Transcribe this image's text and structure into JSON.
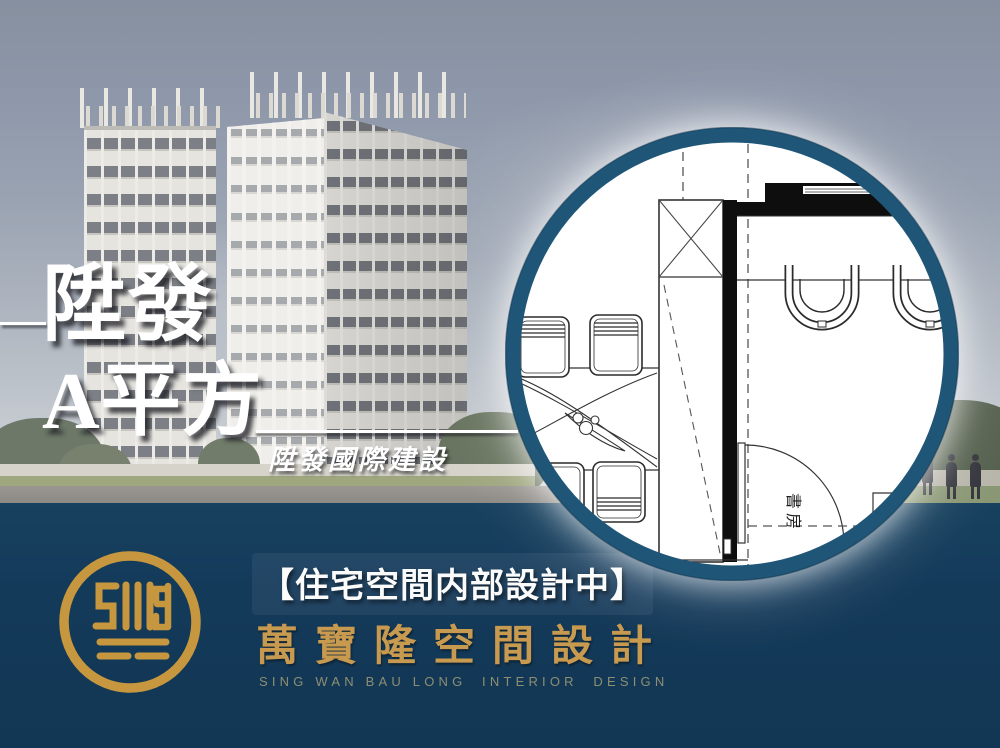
{
  "poster": {
    "title_line1": "陞發",
    "title_line2": "A平方",
    "developer_caption": "陞發國際建設",
    "floor_plan": {
      "room_label": "書房"
    },
    "footer": {
      "status_text": "【住宅空間内部設計中】",
      "brand_name_cn": "萬寶隆空間設計",
      "brand_name_en": "SING WAN BAU LONG  INTERIOR  DESIGN",
      "logo_icon": "swb-monogram-icon"
    },
    "colors": {
      "band_navy": "#143a5a",
      "ring_navy": "#1f5678",
      "logo_gold": "#c6973e",
      "brand_gold": "#c89a50",
      "brand_en_gray": "#8e8e72",
      "sky_top": "#86909f"
    }
  }
}
